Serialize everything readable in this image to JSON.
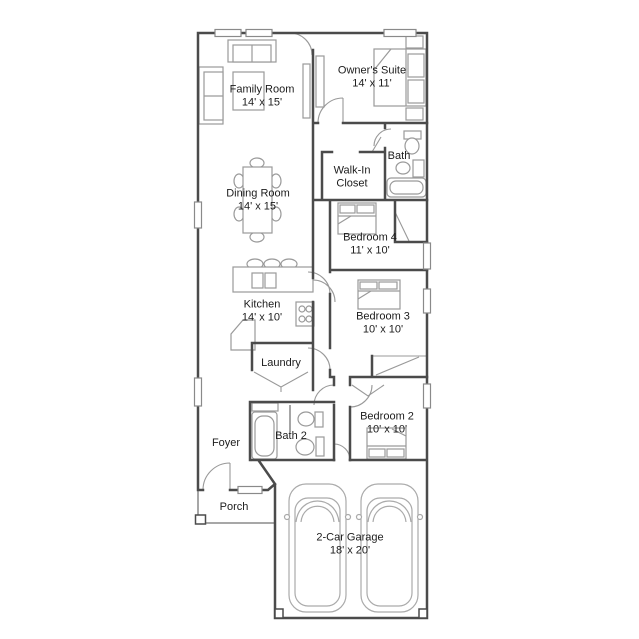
{
  "colors": {
    "wall": "#4b4b4b",
    "furniture": "#9a9a9a",
    "door": "#999999",
    "porch_line": "#8a8a8a",
    "text": "#1c1c1c",
    "background": "#ffffff"
  },
  "rooms": {
    "family_room": {
      "name": "Family Room",
      "dims": "14' x 15'"
    },
    "owners_suite": {
      "name": "Owner's Suite",
      "dims": "14' x 11'"
    },
    "walk_in_closet": {
      "name": "Walk-In Closet"
    },
    "bath": {
      "name": "Bath"
    },
    "dining_room": {
      "name": "Dining Room",
      "dims": "14' x 15'"
    },
    "bedroom_4": {
      "name": "Bedroom 4",
      "dims": "11' x 10'"
    },
    "kitchen": {
      "name": "Kitchen",
      "dims": "14' x 10'"
    },
    "bedroom_3": {
      "name": "Bedroom 3",
      "dims": "10' x 10'"
    },
    "laundry": {
      "name": "Laundry"
    },
    "bedroom_2": {
      "name": "Bedroom 2",
      "dims": "10' x 10'"
    },
    "bath_2": {
      "name": "Bath 2"
    },
    "foyer": {
      "name": "Foyer"
    },
    "porch": {
      "name": "Porch"
    },
    "garage": {
      "name": "2-Car Garage",
      "dims": "18' x 20'"
    }
  }
}
